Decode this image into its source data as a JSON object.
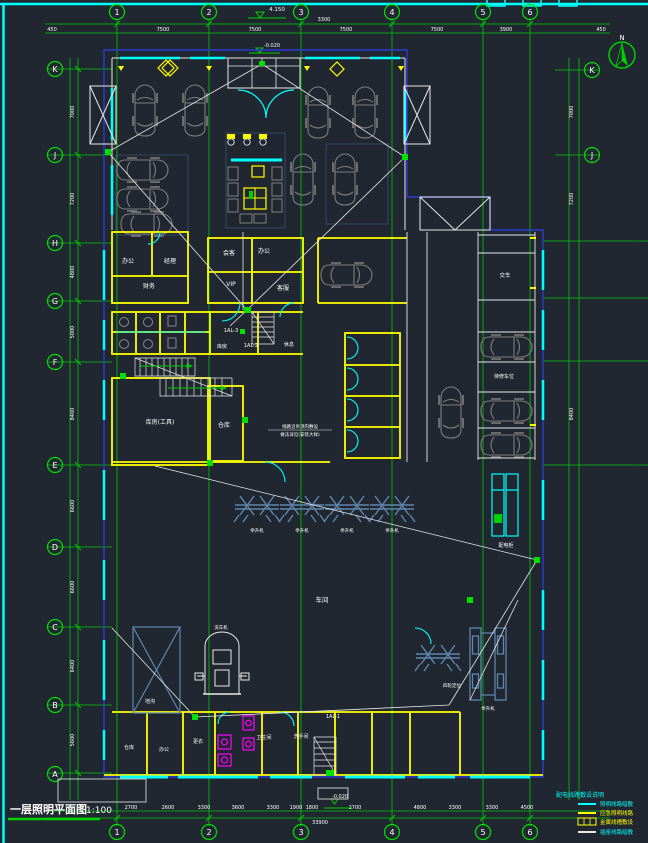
{
  "title_block": {
    "title": "一层照明平面图",
    "scale": "1:100"
  },
  "north_arrow": {
    "label": "N"
  },
  "grid": {
    "columns": [
      "1",
      "2",
      "3",
      "4",
      "5",
      "6"
    ],
    "rows_left": [
      "K",
      "J",
      "H",
      "G",
      "F",
      "E",
      "D",
      "C",
      "B",
      "A"
    ],
    "rows_right": [
      "K",
      "J"
    ]
  },
  "dimensions": {
    "top": [
      "7500",
      "7500",
      "7500",
      "7500",
      "3900"
    ],
    "top_note": "3300",
    "end_left": "450",
    "end_right": "450",
    "bottom": [
      "2700",
      "2600",
      "3300",
      "3600",
      "3300",
      "1900",
      "1800",
      "2700",
      "4800",
      "3300",
      "3300",
      "4500"
    ],
    "bottom_total": "33900",
    "left": [
      "7000",
      "7200",
      "4800",
      "5000",
      "8400",
      "6600",
      "6600",
      "6400",
      "5600"
    ],
    "right": [
      "7000",
      "7200",
      "8400"
    ]
  },
  "levels": {
    "top": "4.150",
    "entrance": "-0.020",
    "bottom": "-0.020"
  },
  "rooms": {
    "office1": "办公",
    "manager": "经理",
    "finance": "财务",
    "meeting": "会客",
    "office2": "办公",
    "vip": "VIP",
    "service": "客服",
    "storage1": "库房",
    "rest": "休息",
    "tool_store": "库房(工具)",
    "storage2": "仓库",
    "delivery": "交车",
    "wait_repair": "待修车位",
    "workshop": "车间",
    "pit": "地沟",
    "car_wash": "洗车机",
    "wheel_align": "四轮定位",
    "lift": "举升机",
    "power_cab": "配电柜",
    "storage3": "仓库",
    "office3": "办公",
    "locker": "更衣",
    "toilet": "卫生间",
    "washroom": "洗手间"
  },
  "panels": {
    "al3": "1AL-3",
    "al2": "1AL-2",
    "al1": "1AL-1"
  },
  "notes": {
    "line1": "线路沿吊顶内敷设",
    "line2": "做法详见(安装大样)"
  },
  "legend": {
    "title": "配电线路敷设说明",
    "items": [
      {
        "label": "照明线路暗敷",
        "color": "#00ffff",
        "swatch": "line"
      },
      {
        "label": "应急照明线路",
        "color": "#ffff00",
        "swatch": "line"
      },
      {
        "label": "金属线槽敷设",
        "color": "#ffff00",
        "swatch": "box"
      },
      {
        "label": "插座线路暗敷",
        "color": "#00ffff",
        "swatch": "line"
      }
    ]
  },
  "colors": {
    "background": "#202731",
    "grid_green": "#00cf00",
    "wall_yellow": "#ffff00",
    "window_cyan": "#00ffff",
    "outline_blue": "#2b3bd6",
    "car_gray": "#7e7e7e",
    "equipment_blue": "#5f86ad",
    "fixture_magenta": "#ff00ff",
    "text_white": "#ffffff"
  }
}
